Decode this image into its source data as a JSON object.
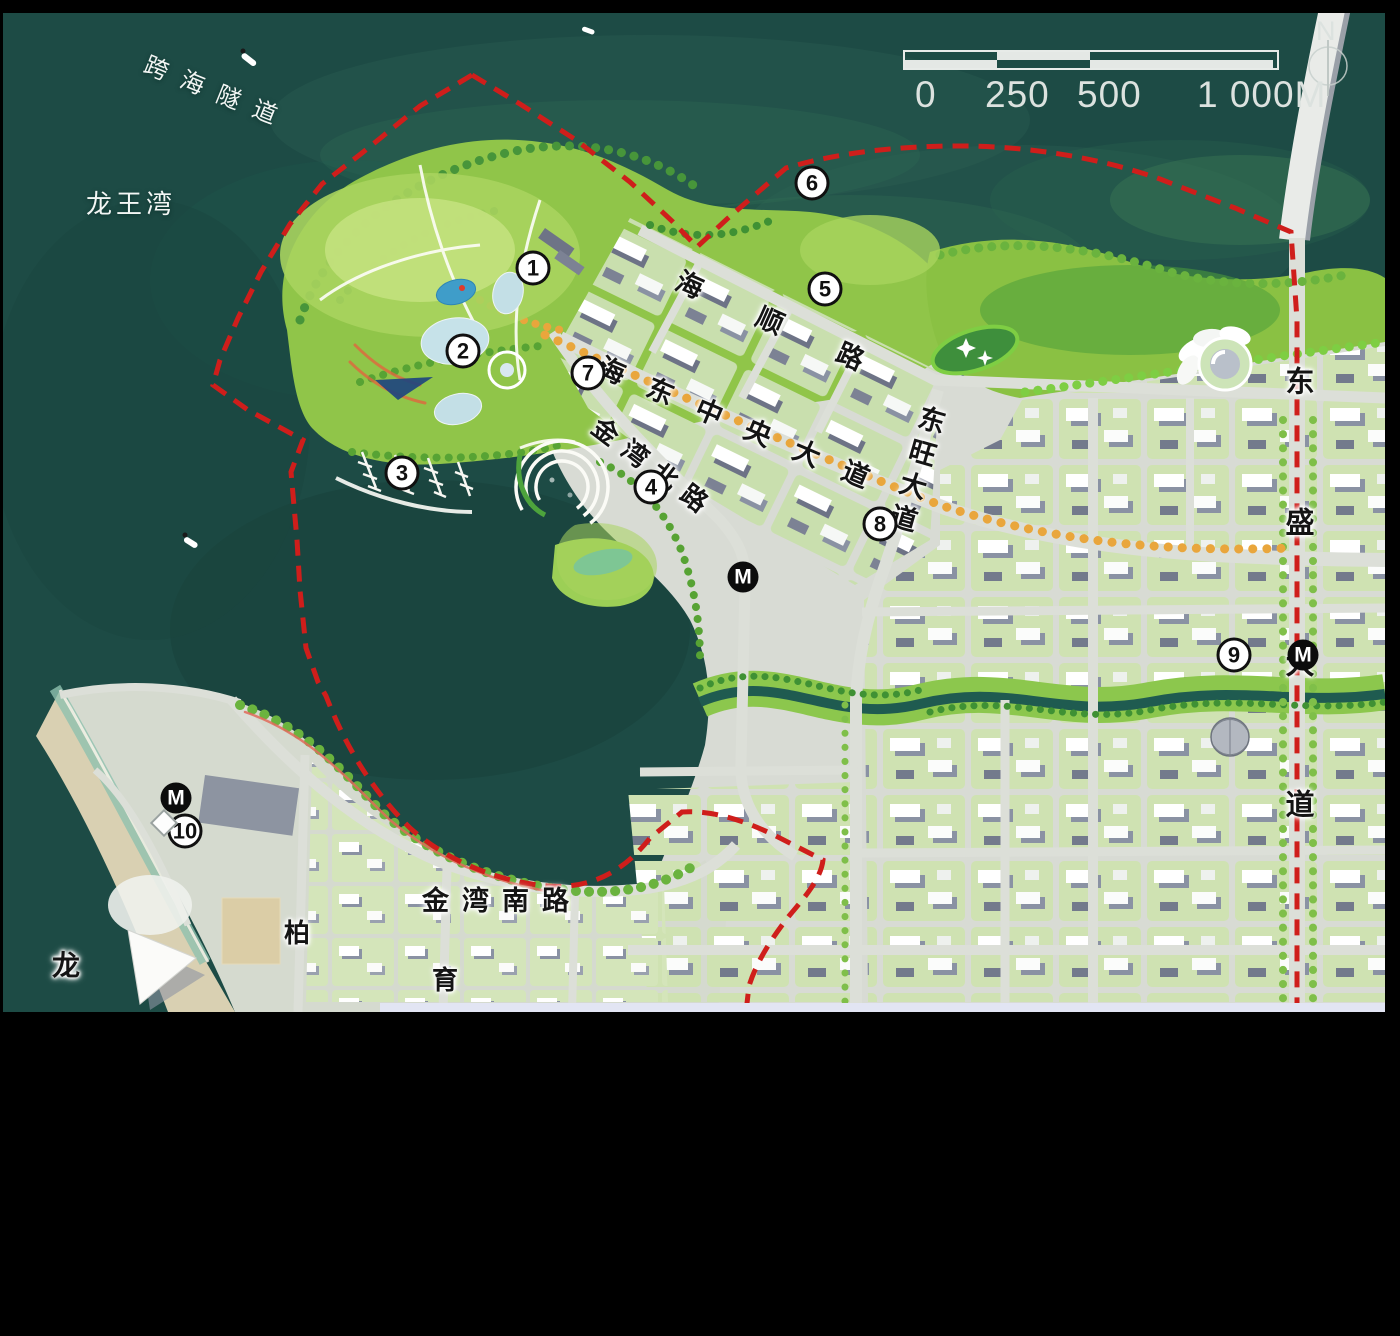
{
  "map": {
    "water_labels": {
      "tunnel": "跨海隧道",
      "bay": "龙王湾"
    },
    "road_labels": {
      "haishun": "海顺路",
      "haidong_central": "海东中央大道",
      "jinwan_north": "金湾北路",
      "dongwang": "东旺大道",
      "dongsheng": "东盛大道",
      "jinwan_south": "金湾南路",
      "bai": "柏",
      "yu": "育",
      "long": "龙"
    },
    "plan_markers": [
      {
        "label": "1"
      },
      {
        "label": "2"
      },
      {
        "label": "3"
      },
      {
        "label": "4"
      },
      {
        "label": "5"
      },
      {
        "label": "6"
      },
      {
        "label": "7"
      },
      {
        "label": "8"
      },
      {
        "label": "9"
      },
      {
        "label": "10"
      }
    ],
    "metro": {
      "symbol": "M",
      "station_count": 3
    },
    "compass": {
      "north_label": "N"
    },
    "scale_bar": {
      "tick_labels": [
        "0",
        "250",
        "500",
        "1 000M"
      ]
    },
    "colors": {
      "sea": "#1d4b45",
      "park_green": "#8cc344",
      "city_ground": "#d8dbd4",
      "road": "#dcdfd8",
      "boundary_red": "#cf1e1b",
      "avenue_orange": "#e9a63c",
      "building_white": "#ffffff",
      "building_shadow": "#8a92a3",
      "sand": "#d9d0b2"
    }
  }
}
